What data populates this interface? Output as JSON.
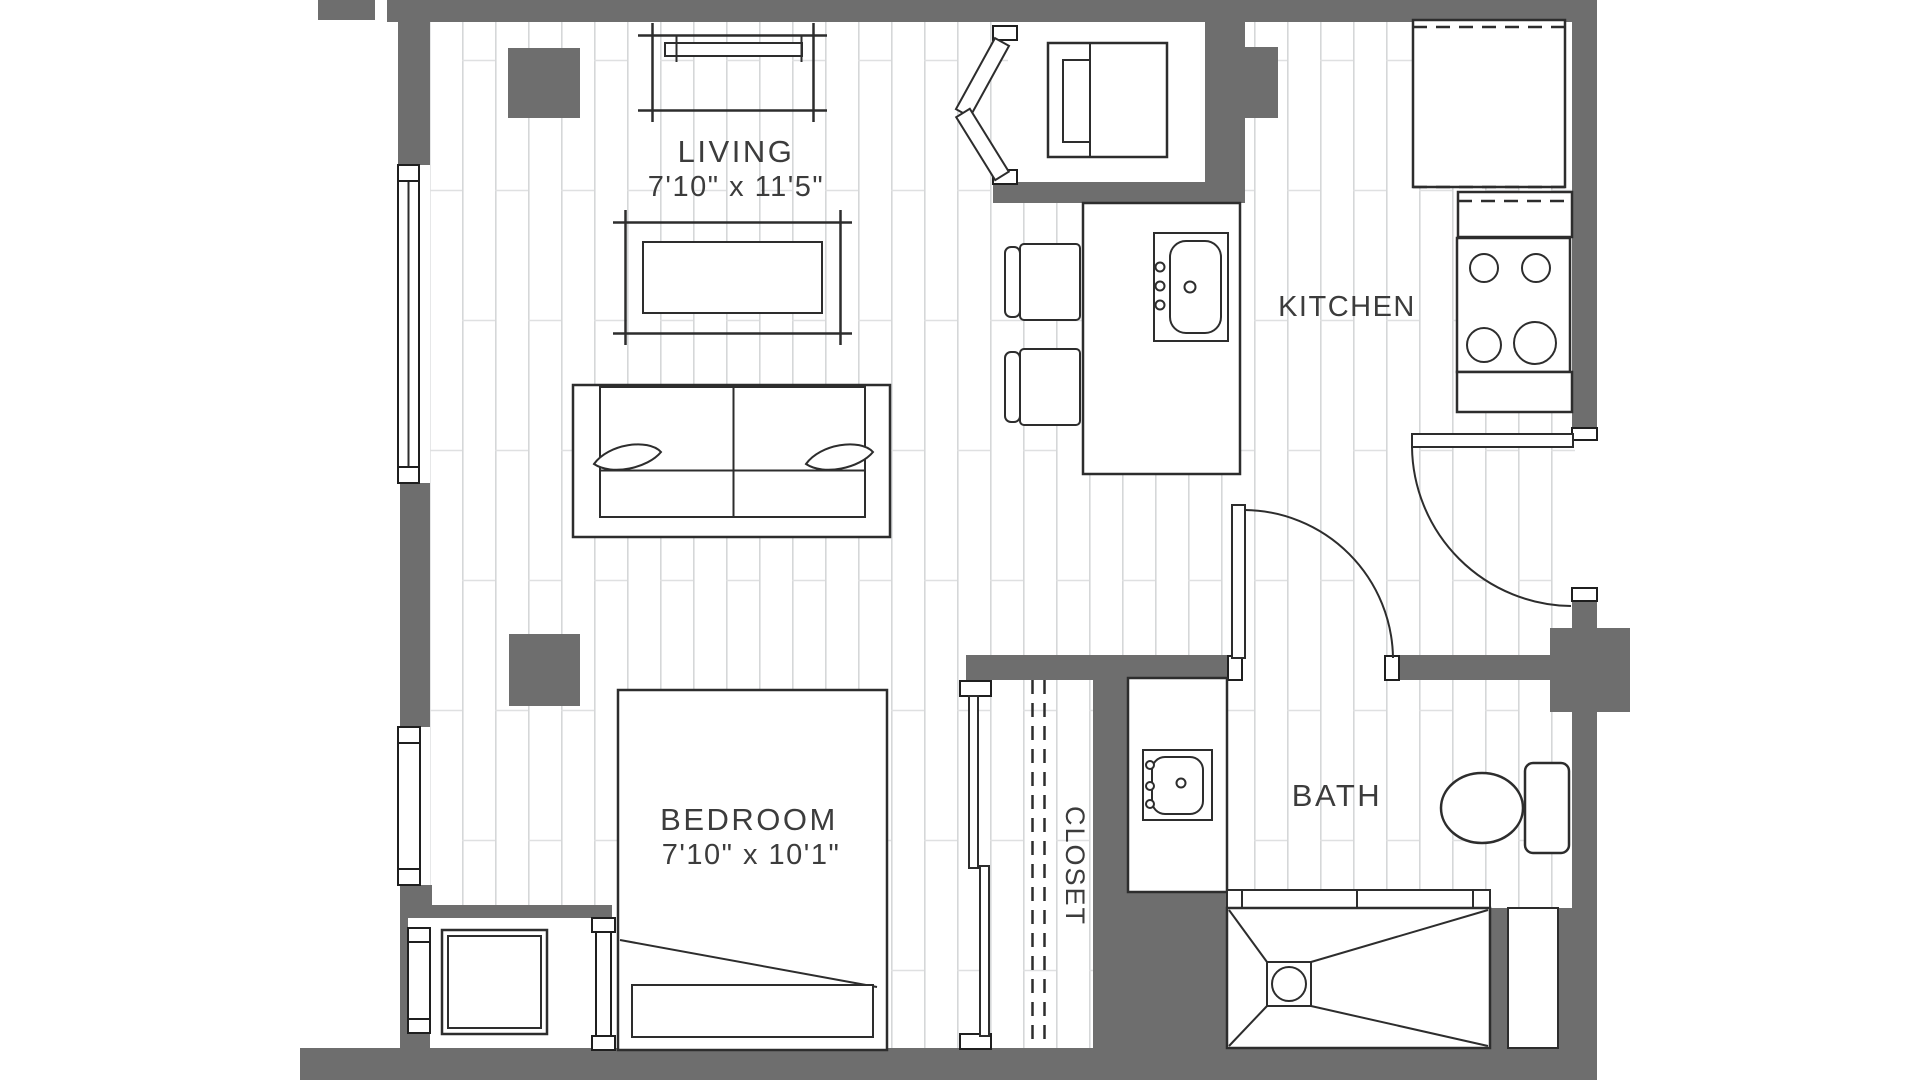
{
  "floor_plan": {
    "rooms": {
      "living": {
        "label": "LIVING",
        "dimensions": "7'10\" x 11'5\""
      },
      "kitchen": {
        "label": "KITCHEN"
      },
      "bedroom": {
        "label": "BEDROOM",
        "dimensions": "7'10\" x 10'1\""
      },
      "closet": {
        "label": "CLOSET"
      },
      "bath": {
        "label": "BATH"
      }
    },
    "colors": {
      "wall": "#6e6e6e",
      "fixture_line": "#2d2d2d",
      "floor_plank_line": "#d5d7d8",
      "text": "#3c3c3c",
      "background": "#ffffff"
    },
    "fixtures": [
      "media-console",
      "coffee-table",
      "sofa",
      "structural-column",
      "washer-dryer",
      "kitchen-island",
      "island-sink",
      "bar-stool",
      "refrigerator",
      "range",
      "counter",
      "bed",
      "closet-rod",
      "sliding-door",
      "bathroom-vanity",
      "vanity-sink",
      "toilet",
      "shower",
      "shower-drain",
      "window",
      "entry-door",
      "bath-door",
      "bifold-door",
      "storage-unit"
    ]
  }
}
